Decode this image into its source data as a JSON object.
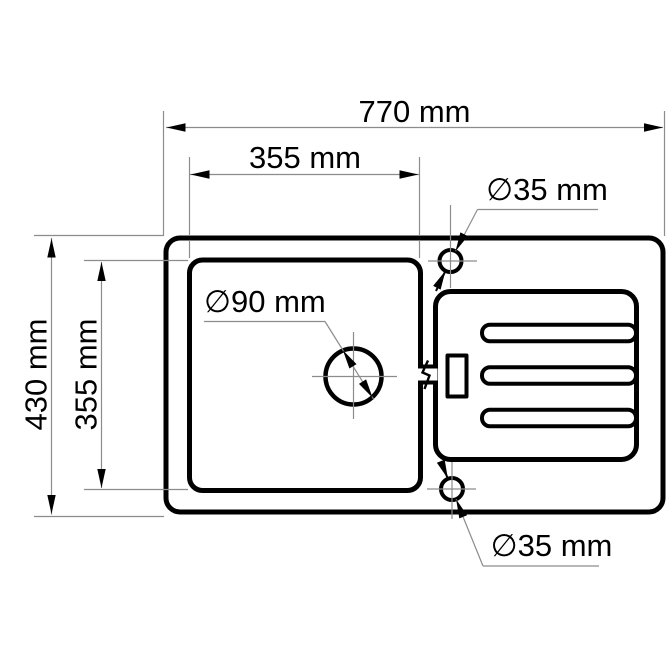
{
  "drawing": {
    "title": "Kitchen sink top-view dimension drawing",
    "unit": "mm",
    "labels": {
      "overall_width": "770 mm",
      "bowl_width": "355 mm",
      "overall_depth": "430 mm",
      "bowl_depth": "355 mm",
      "drain_hole": "∅90 mm",
      "tap_hole_top": "∅35 mm",
      "tap_hole_bottom": "∅35 mm"
    },
    "dimensions_mm": {
      "overall_width": 770,
      "overall_depth": 430,
      "bowl_width": 355,
      "bowl_depth": 355,
      "drain_hole_diameter": 90,
      "tap_hole_diameter": 35
    },
    "colors": {
      "outline": "#000000",
      "dimension_line": "#8c8c8c",
      "background": "#ffffff"
    }
  }
}
